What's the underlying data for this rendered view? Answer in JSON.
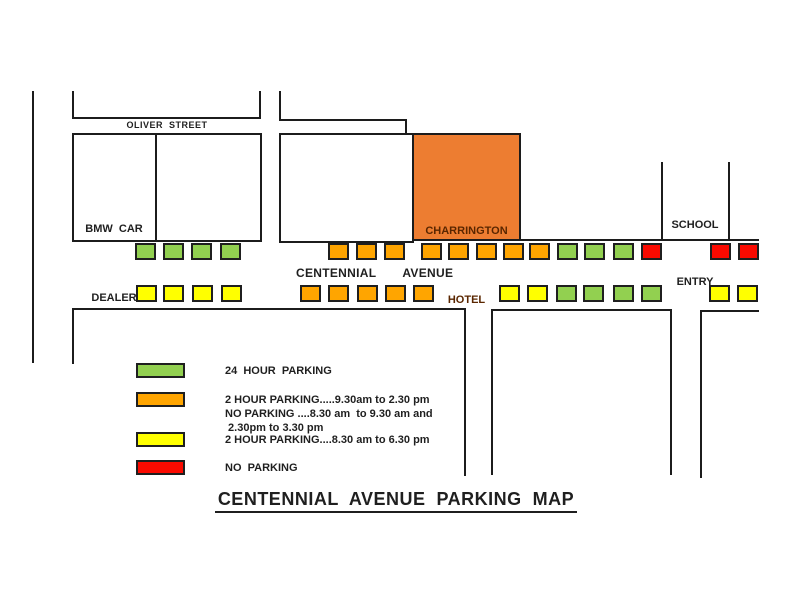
{
  "title": "CENTENNIAL  AVENUE  PARKING  MAP",
  "streets": {
    "oliver": "OLIVER  STREET",
    "centennial_word1": "CENTENNIAL",
    "centennial_word2": "AVENUE"
  },
  "buildings": {
    "bmw_line1": "BMW  CAR",
    "bmw_line2": "DEALER",
    "hotel_line1": "CHARRINGTON",
    "hotel_line2": "HOTEL",
    "school_line1": "SCHOOL",
    "school_line2": "ENTRY"
  },
  "colors": {
    "green": "#92D050",
    "orange": "#FFA500",
    "yellow": "#FFFF00",
    "red": "#FB0A00",
    "hotel": "#ED7D31",
    "line": "#1c1c1c"
  },
  "legend": [
    {
      "swatch": "green",
      "meaning": "24 hour parking",
      "lines": [
        "24  HOUR  PARKING"
      ]
    },
    {
      "swatch": "orange",
      "meaning": "2 hour parking 9.30am-2.30pm; no parking 8.30-9.30am and 2.30-3.30pm",
      "lines": [
        "2 HOUR PARKING.....9.30am to 2.30 pm",
        "NO PARKING ....8.30 am  to 9.30 am and",
        " 2.30pm to 3.30 pm"
      ]
    },
    {
      "swatch": "yellow",
      "meaning": "2 hour parking 8.30am-6.30pm",
      "lines": [
        "2 HOUR PARKING....8.30 am to 6.30 pm"
      ]
    },
    {
      "swatch": "red",
      "meaning": "no parking",
      "lines": [
        "NO  PARKING"
      ]
    }
  ],
  "parking_rows": {
    "north": [
      {
        "x": 135,
        "color": "green"
      },
      {
        "x": 163,
        "color": "green"
      },
      {
        "x": 191,
        "color": "green"
      },
      {
        "x": 220,
        "color": "green"
      },
      {
        "x": 328,
        "color": "orange"
      },
      {
        "x": 356,
        "color": "orange"
      },
      {
        "x": 384,
        "color": "orange"
      },
      {
        "x": 421,
        "color": "orange"
      },
      {
        "x": 448,
        "color": "orange"
      },
      {
        "x": 476,
        "color": "orange"
      },
      {
        "x": 503,
        "color": "orange"
      },
      {
        "x": 529,
        "color": "orange"
      },
      {
        "x": 557,
        "color": "green"
      },
      {
        "x": 584,
        "color": "green"
      },
      {
        "x": 613,
        "color": "green"
      },
      {
        "x": 641,
        "color": "red"
      },
      {
        "x": 710,
        "color": "red"
      },
      {
        "x": 738,
        "color": "red"
      }
    ],
    "south": [
      {
        "x": 136,
        "color": "yellow"
      },
      {
        "x": 163,
        "color": "yellow"
      },
      {
        "x": 192,
        "color": "yellow"
      },
      {
        "x": 221,
        "color": "yellow"
      },
      {
        "x": 300,
        "color": "orange"
      },
      {
        "x": 328,
        "color": "orange"
      },
      {
        "x": 357,
        "color": "orange"
      },
      {
        "x": 385,
        "color": "orange"
      },
      {
        "x": 413,
        "color": "orange"
      },
      {
        "x": 499,
        "color": "yellow"
      },
      {
        "x": 527,
        "color": "yellow"
      },
      {
        "x": 556,
        "color": "green"
      },
      {
        "x": 583,
        "color": "green"
      },
      {
        "x": 613,
        "color": "green"
      },
      {
        "x": 641,
        "color": "green"
      },
      {
        "x": 709,
        "color": "yellow"
      },
      {
        "x": 737,
        "color": "yellow"
      }
    ]
  }
}
